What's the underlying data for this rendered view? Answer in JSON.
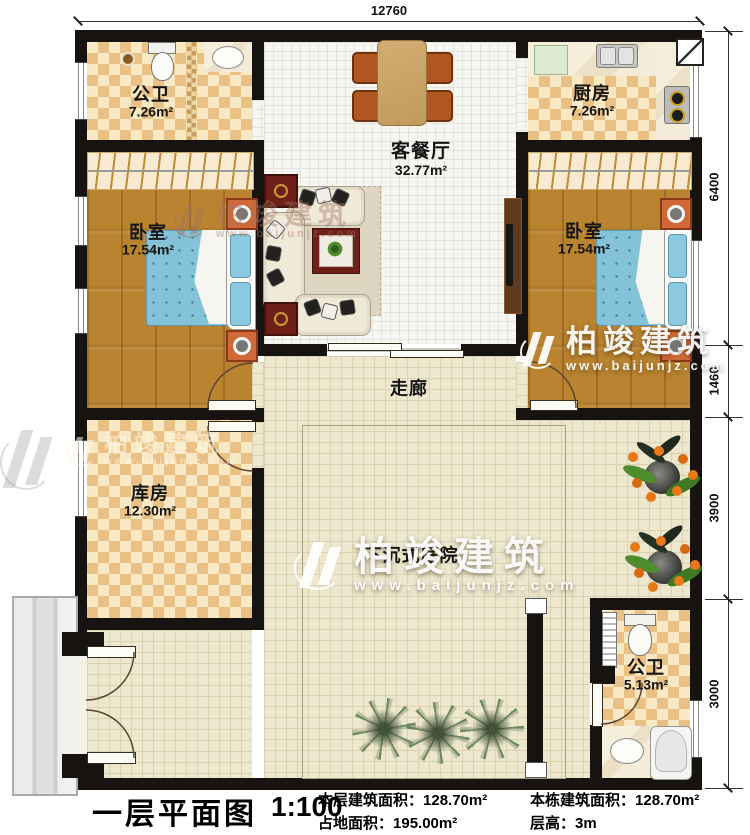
{
  "plan": {
    "title": "一层平面图",
    "scale": "1:100",
    "stats": [
      {
        "label": "本层建筑面积：",
        "value": "128.70m²"
      },
      {
        "label": "占地面积：",
        "value": "195.00m²"
      },
      {
        "label": "本栋建筑面积：",
        "value": "128.70m²"
      },
      {
        "label": "层高：",
        "value": "3m"
      }
    ]
  },
  "dimensions": {
    "top": "12760",
    "right": [
      "6400",
      "1460",
      "3900",
      "3000"
    ]
  },
  "rooms": {
    "bath_top": {
      "name": "公卫",
      "area": "7.26m²"
    },
    "kitchen": {
      "name": "厨房",
      "area": "7.26m²"
    },
    "living": {
      "name": "客餐厅",
      "area": "32.77m²"
    },
    "bedroom_left": {
      "name": "卧室",
      "area": "17.54m²"
    },
    "bedroom_right": {
      "name": "卧室",
      "area": "17.54m²"
    },
    "corridor": {
      "name": "走廊"
    },
    "storage": {
      "name": "库房",
      "area": "12.30m²"
    },
    "courtyard": {
      "name": "下沉式庭院"
    },
    "bath_bottom": {
      "name": "公卫",
      "area": "5.13m²"
    }
  },
  "watermark": {
    "brand": "柏竣建筑",
    "url": "www.baijunjz.com"
  },
  "colors": {
    "wall": "#171310",
    "checker_dark": "#e9c185",
    "checker_light": "#f8e9c4",
    "wood_floor": "#b9832f",
    "living_tile": "#f6f6f2",
    "courtyard_tile": "#ece7cd",
    "bed_blue": "#84c2d8",
    "chair_orange": "#b05620",
    "accent_red_table": "#6e2018"
  },
  "icons": {
    "toilet": "toilet-icon",
    "sink": "sink-icon",
    "shower": "shower-icon",
    "stove": "stove-icon",
    "fridge": "fridge-icon",
    "bed": "bed-icon",
    "sofa": "sofa-icon",
    "dining-table": "dining-table-icon",
    "tv": "tv-icon",
    "wardrobe": "wardrobe-icon",
    "plant": "plant-icon",
    "stairs": "stairs-icon"
  }
}
